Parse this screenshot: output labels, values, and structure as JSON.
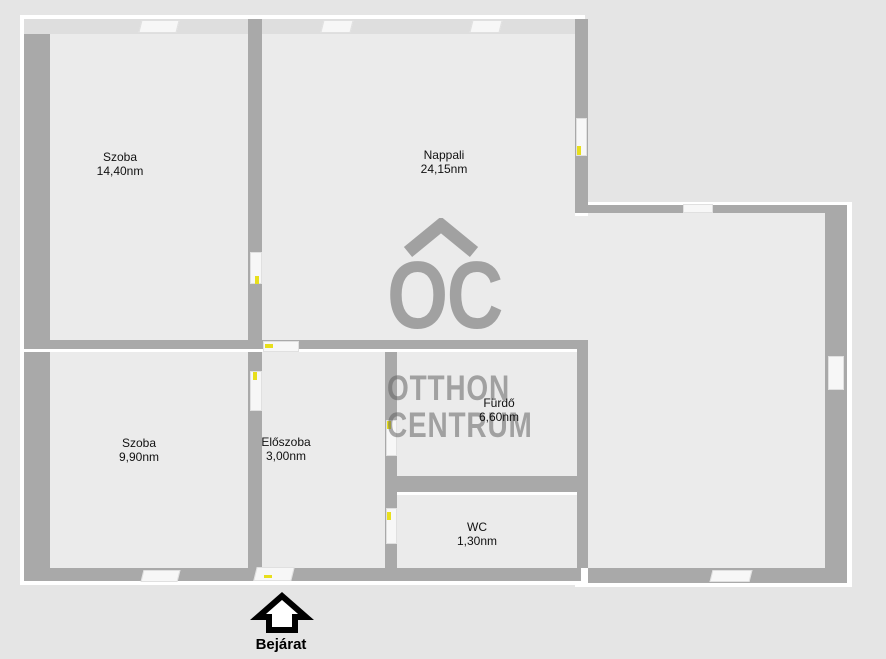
{
  "floorplan": {
    "title": "apartment-floorplan",
    "colors": {
      "background": "#e5e5e5",
      "floor": "#ebebeb",
      "wall": "#a9a9a9",
      "outline": "#ffffff",
      "door_tick": "#e8df1c",
      "watermark": "#9d9d9d",
      "label_text": "#111111"
    },
    "rooms": [
      {
        "id": "szoba1",
        "name": "Szoba",
        "area": "14,40nm"
      },
      {
        "id": "nappali",
        "name": "Nappali",
        "area": "24,15nm"
      },
      {
        "id": "szoba2",
        "name": "Szoba",
        "area": "9,90nm"
      },
      {
        "id": "eloszoba",
        "name": "Előszoba",
        "area": "3,00nm"
      },
      {
        "id": "furdo",
        "name": "Fürdő",
        "area": "6,60nm"
      },
      {
        "id": "wc",
        "name": "WC",
        "area": "1,30nm"
      }
    ],
    "entrance": {
      "label": "Bejárat"
    },
    "watermark": {
      "logo": "OC",
      "line1": "OTTHON",
      "line2": "CENTRUM"
    }
  }
}
